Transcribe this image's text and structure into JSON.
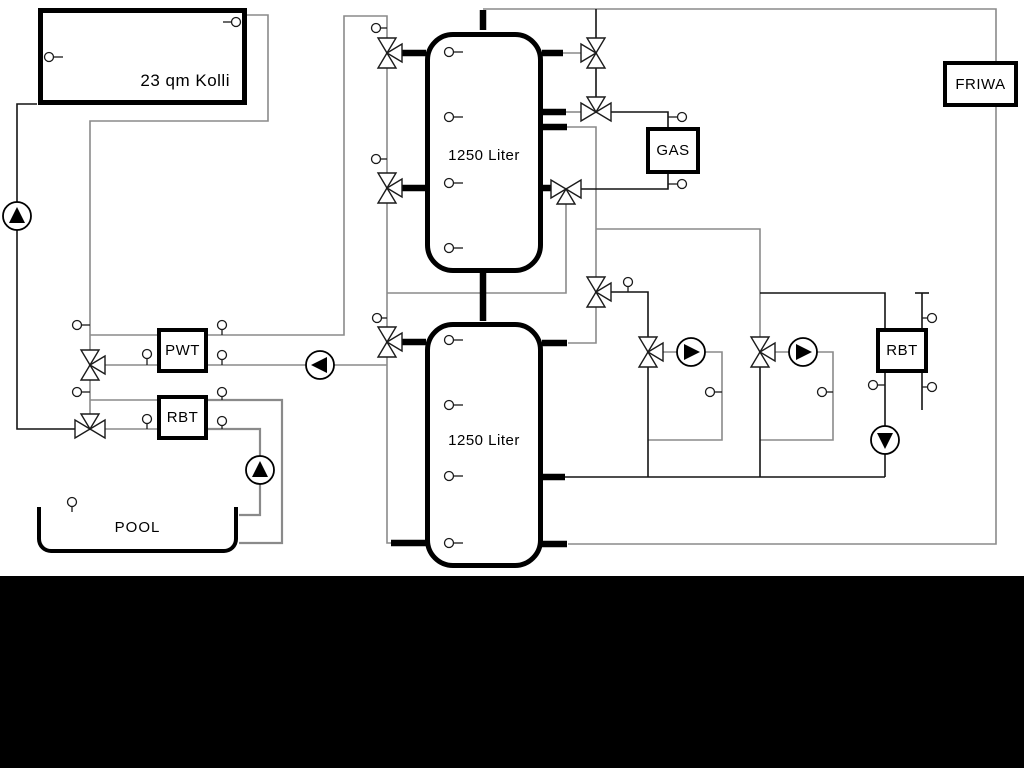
{
  "diagram": {
    "title_hint": "solar / buffer tank heating schematic",
    "collector": {
      "label": "23 qm Kolli"
    },
    "buffer_tank_top": {
      "label": "1250 Liter"
    },
    "buffer_tank_bottom": {
      "label": "1250 Liter"
    },
    "gas_boiler": {
      "label": "GAS"
    },
    "fresh_water_station": {
      "label": "FRIWA"
    },
    "plate_heat_exchanger": {
      "label": "PWT"
    },
    "return_controller_left": {
      "label": "RBT"
    },
    "return_controller_right": {
      "label": "RBT"
    },
    "pool": {
      "label": "POOL"
    },
    "symbols": {
      "three_way_valve_count": 11,
      "pump_count": 6,
      "sensor_count": 30
    },
    "colors": {
      "pipe_gray": "#8a8a8a",
      "pipe_black": "#141414",
      "component_border": "#000000",
      "background": "#ffffff",
      "bottom_band": "#000000"
    }
  }
}
